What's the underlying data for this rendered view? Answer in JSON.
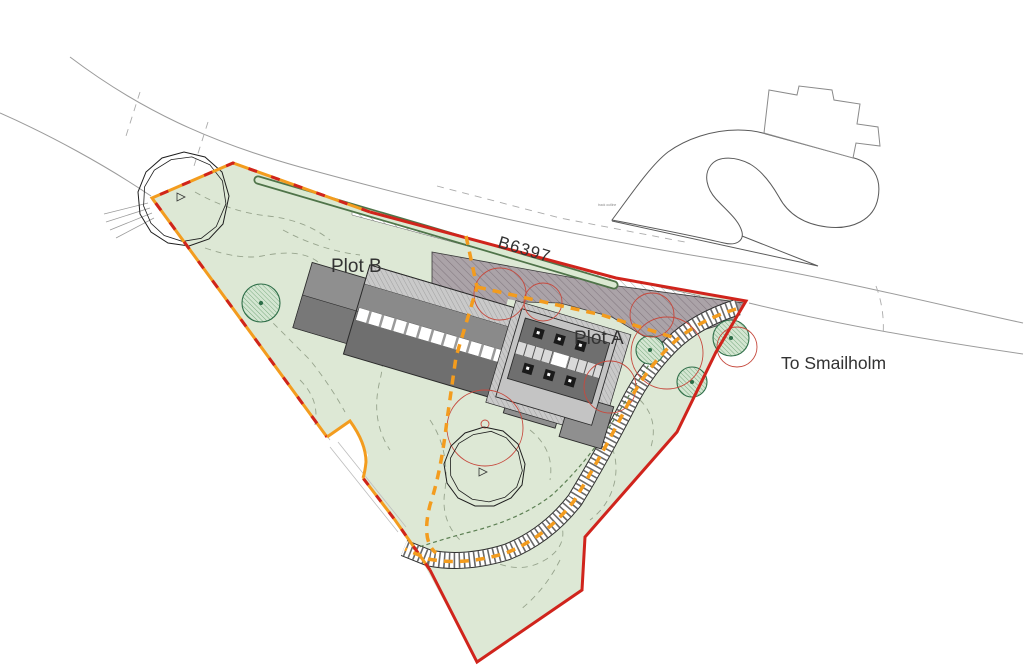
{
  "page": {
    "title": "Site plan drawing"
  },
  "labels": {
    "road": "B6397",
    "direction": "To Smailholm",
    "plot_a": "Plot A",
    "plot_b": "Plot B",
    "driveway_note": "track outline"
  },
  "colors": {
    "site_fill": "#dde8d5",
    "boundary_red": "#d0241c",
    "boundary_orange": "#f39c1e",
    "tree_removal_red": "#c64a3e",
    "hedge_green": "#4f7449",
    "hedge_fill": "#dbe9d2",
    "tree_green": "#2e6e48",
    "tree_fill": "#d4e6d2",
    "contour_green": "#97a48d",
    "road_gray": "#9b9b9b",
    "outline_dark": "#2b2b2b",
    "roof_dark": "#6f6f6f",
    "roof_mid": "#8a8a8a",
    "wall_light": "#c4c4c4",
    "courtyard_fill": "#aba3a8",
    "courtyard_hatch": "#837880"
  }
}
